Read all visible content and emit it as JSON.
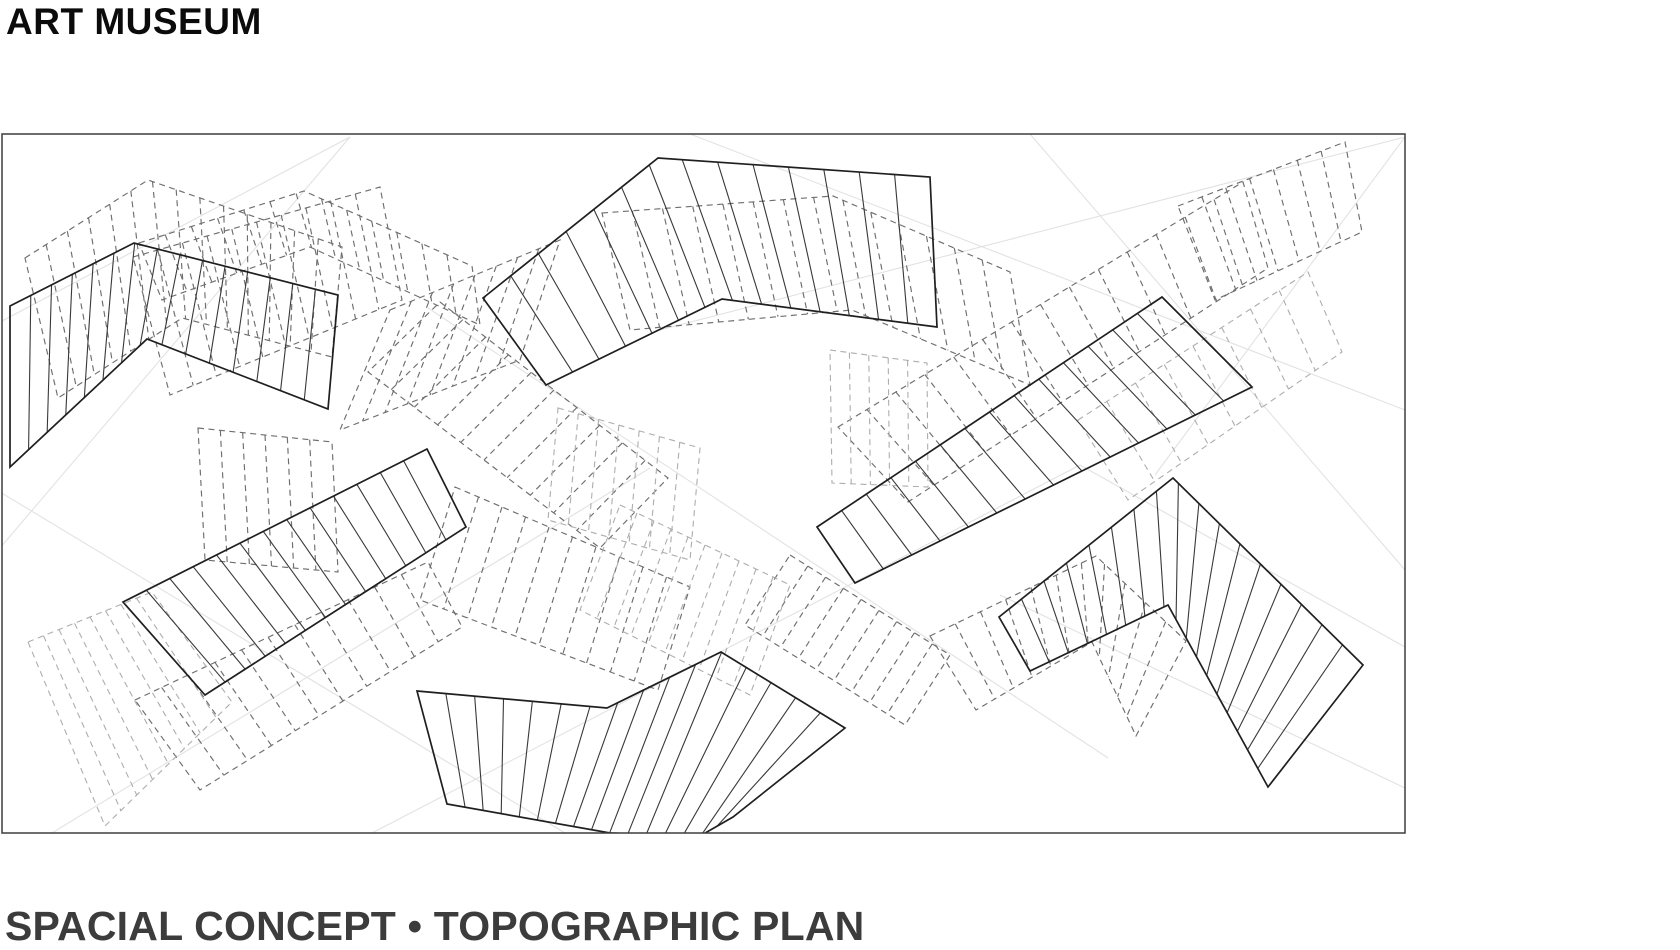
{
  "page": {
    "width": 1680,
    "height": 950,
    "background": "#ffffff"
  },
  "header": {
    "title": "ART MUSEUM"
  },
  "caption": {
    "text": "SPACIAL CONCEPT • TOPOGRAPHIC PLAN"
  },
  "drawing": {
    "frame": {
      "x": 2,
      "y": 134,
      "width": 1403,
      "height": 699,
      "stroke": "#3d3d3d",
      "stroke_width": 1.5
    },
    "construction_color": "#e2e2e2",
    "styles": {
      "solid": {
        "stroke": "#1f1f1f",
        "hatch_stroke": "#383838",
        "dash": "",
        "outline_width": 1.7,
        "hatch_width": 1.1
      },
      "dashed-dark": {
        "stroke": "#6e6e6e",
        "hatch_stroke": "#6e6e6e",
        "dash": "6 4.5",
        "outline_width": 1.15,
        "hatch_width": 1.15
      },
      "dashed-light": {
        "stroke": "#adadad",
        "hatch_stroke": "#adadad",
        "dash": "6 4.5",
        "outline_width": 1.1,
        "hatch_width": 1.1
      }
    },
    "construction_lines": [
      {
        "x1": 350,
        "y1": 137,
        "x2": 0,
        "y2": 322
      },
      {
        "x1": 350,
        "y1": 137,
        "x2": 0,
        "y2": 548
      },
      {
        "x1": 690,
        "y1": 134,
        "x2": 1405,
        "y2": 410
      },
      {
        "x1": 1030,
        "y1": 134,
        "x2": 1405,
        "y2": 570
      },
      {
        "x1": 1405,
        "y1": 137,
        "x2": 660,
        "y2": 330
      },
      {
        "x1": 1405,
        "y1": 137,
        "x2": 1155,
        "y2": 475
      },
      {
        "x1": 0,
        "y1": 492,
        "x2": 565,
        "y2": 833
      },
      {
        "x1": 52,
        "y1": 833,
        "x2": 650,
        "y2": 468
      },
      {
        "x1": 372,
        "y1": 833,
        "x2": 1080,
        "y2": 465
      },
      {
        "x1": 1080,
        "y1": 465,
        "x2": 1405,
        "y2": 647
      },
      {
        "x1": 1000,
        "y1": 595,
        "x2": 1405,
        "y2": 788
      },
      {
        "x1": 428,
        "y1": 308,
        "x2": 1108,
        "y2": 758
      }
    ],
    "bands": [
      {
        "id": "ghost-top-left-chevron",
        "style": "dashed-dark",
        "hatch_count": 13,
        "top": [
          [
            25,
            258
          ],
          [
            148,
            180
          ],
          [
            342,
            247
          ]
        ],
        "bottom": [
          [
            58,
            398
          ],
          [
            182,
            318
          ],
          [
            332,
            357
          ]
        ]
      },
      {
        "id": "ghost-top-left-tilted",
        "style": "dashed-dark",
        "hatch_count": 9,
        "top": [
          [
            133,
            257
          ],
          [
            380,
            187
          ]
        ],
        "bottom": [
          [
            170,
            395
          ],
          [
            402,
            300
          ]
        ]
      },
      {
        "id": "ghost-upper-center-chevron",
        "style": "dashed-dark",
        "hatch_count": 12,
        "top": [
          [
            139,
            243
          ],
          [
            304,
            191
          ],
          [
            472,
            266
          ]
        ],
        "bottom": [
          [
            162,
            300
          ],
          [
            310,
            247
          ],
          [
            480,
            325
          ]
        ]
      },
      {
        "id": "ghost-center-right-band",
        "style": "dashed-dark",
        "hatch_count": 13,
        "top": [
          [
            602,
            213
          ],
          [
            833,
            196
          ],
          [
            1010,
            272
          ]
        ],
        "bottom": [
          [
            630,
            330
          ],
          [
            852,
            310
          ],
          [
            1030,
            385
          ]
        ]
      },
      {
        "id": "ghost-center-steep-band",
        "style": "dashed-dark",
        "hatch_count": 7,
        "top": [
          [
            390,
            310
          ],
          [
            560,
            240
          ]
        ],
        "bottom": [
          [
            340,
            430
          ],
          [
            520,
            360
          ]
        ]
      },
      {
        "id": "ghost-center-ladder",
        "style": "dashed-dark",
        "hatch_count": 9,
        "top": [
          [
            440,
            302
          ],
          [
            668,
            478
          ]
        ],
        "bottom": [
          [
            368,
            372
          ],
          [
            600,
            548
          ]
        ]
      },
      {
        "id": "ghost-diagonal-upper",
        "style": "dashed-dark",
        "hatch_count": 13,
        "top": [
          [
            838,
            427
          ],
          [
            1243,
            182
          ]
        ],
        "bottom": [
          [
            908,
            502
          ],
          [
            1268,
            268
          ]
        ]
      },
      {
        "id": "ghost-top-right-strip",
        "style": "dashed-dark",
        "hatch_count": 6,
        "top": [
          [
            1178,
            206
          ],
          [
            1345,
            142
          ]
        ],
        "bottom": [
          [
            1215,
            300
          ],
          [
            1362,
            232
          ]
        ]
      },
      {
        "id": "ghost-lower-left-strip",
        "style": "dashed-dark",
        "hatch_count": 10,
        "top": [
          [
            135,
            700
          ],
          [
            428,
            562
          ]
        ],
        "bottom": [
          [
            200,
            790
          ],
          [
            462,
            627
          ]
        ]
      },
      {
        "id": "ghost-mid-bottom-steep",
        "style": "dashed-dark",
        "hatch_count": 9,
        "top": [
          [
            455,
            487
          ],
          [
            690,
            587
          ]
        ],
        "bottom": [
          [
            420,
            600
          ],
          [
            658,
            690
          ]
        ]
      },
      {
        "id": "ghost-right-chevron-echo",
        "style": "dashed-dark",
        "hatch_count": 10,
        "top": [
          [
            930,
            636
          ],
          [
            1096,
            556
          ],
          [
            1186,
            641
          ]
        ],
        "bottom": [
          [
            976,
            710
          ],
          [
            1092,
            642
          ],
          [
            1136,
            736
          ]
        ]
      },
      {
        "id": "ghost-left-middle-box",
        "style": "dashed-dark",
        "hatch_count": 5,
        "top": [
          [
            198,
            428
          ],
          [
            332,
            442
          ]
        ],
        "bottom": [
          [
            205,
            560
          ],
          [
            338,
            572
          ]
        ]
      },
      {
        "id": "ghost-mid-right-descent",
        "style": "dashed-dark",
        "hatch_count": 8,
        "top": [
          [
            790,
            555
          ],
          [
            950,
            655
          ]
        ],
        "bottom": [
          [
            745,
            625
          ],
          [
            905,
            725
          ]
        ]
      },
      {
        "id": "faint-right-edge-strip",
        "style": "dashed-light",
        "hatch_count": 7,
        "top": [
          [
            1078,
            420
          ],
          [
            1308,
            272
          ]
        ],
        "bottom": [
          [
            1128,
            500
          ],
          [
            1342,
            352
          ]
        ]
      },
      {
        "id": "faint-bottom-left-fan",
        "style": "dashed-light",
        "hatch_count": 7,
        "top": [
          [
            28,
            642
          ],
          [
            152,
            592
          ]
        ],
        "bottom": [
          [
            105,
            826
          ],
          [
            232,
            702
          ]
        ]
      },
      {
        "id": "faint-center-right-box",
        "style": "dashed-light",
        "hatch_count": 4,
        "top": [
          [
            830,
            350
          ],
          [
            927,
            363
          ]
        ],
        "bottom": [
          [
            832,
            483
          ],
          [
            928,
            487
          ]
        ]
      },
      {
        "id": "faint-center-box",
        "style": "dashed-light",
        "hatch_count": 6,
        "top": [
          [
            558,
            408
          ],
          [
            700,
            448
          ]
        ],
        "bottom": [
          [
            548,
            520
          ],
          [
            690,
            560
          ]
        ]
      },
      {
        "id": "faint-center-ladder",
        "style": "dashed-light",
        "hatch_count": 9,
        "top": [
          [
            620,
            505
          ],
          [
            790,
            585
          ]
        ],
        "bottom": [
          [
            580,
            610
          ],
          [
            750,
            695
          ]
        ]
      },
      {
        "id": "terrace-north-west",
        "style": "solid",
        "hatch_count": 14,
        "top": [
          [
            10,
            306
          ],
          [
            134,
            243
          ],
          [
            338,
            295
          ]
        ],
        "bottom": [
          [
            10,
            467
          ],
          [
            147,
            339
          ],
          [
            328,
            409
          ]
        ]
      },
      {
        "id": "terrace-north-center",
        "style": "solid",
        "hatch_count": 13,
        "top": [
          [
            483,
            298
          ],
          [
            658,
            158
          ],
          [
            930,
            177
          ]
        ],
        "bottom": [
          [
            546,
            385
          ],
          [
            722,
            299
          ],
          [
            937,
            327
          ]
        ]
      },
      {
        "id": "terrace-east-diagonal",
        "style": "solid",
        "hatch_count": 13,
        "top": [
          [
            817,
            527
          ],
          [
            1162,
            297
          ]
        ],
        "bottom": [
          [
            855,
            583
          ],
          [
            1252,
            387
          ]
        ]
      },
      {
        "id": "terrace-west-middle",
        "style": "solid",
        "hatch_count": 12,
        "top": [
          [
            123,
            602
          ],
          [
            427,
            449
          ]
        ],
        "bottom": [
          [
            205,
            695
          ],
          [
            466,
            527
          ]
        ]
      },
      {
        "id": "terrace-south-center",
        "style": "solid",
        "hatch_count": 15,
        "top": [
          [
            417,
            691
          ],
          [
            607,
            708
          ],
          [
            721,
            652
          ],
          [
            845,
            728
          ]
        ],
        "bottom": [
          [
            447,
            804
          ],
          [
            610,
            833
          ],
          [
            700,
            836
          ],
          [
            733,
            817
          ]
        ]
      },
      {
        "id": "terrace-south-east",
        "style": "solid",
        "hatch_count": 16,
        "top": [
          [
            999,
            617
          ],
          [
            1173,
            478
          ],
          [
            1363,
            665
          ]
        ],
        "bottom": [
          [
            1030,
            671
          ],
          [
            1168,
            605
          ],
          [
            1268,
            787
          ]
        ]
      }
    ]
  }
}
